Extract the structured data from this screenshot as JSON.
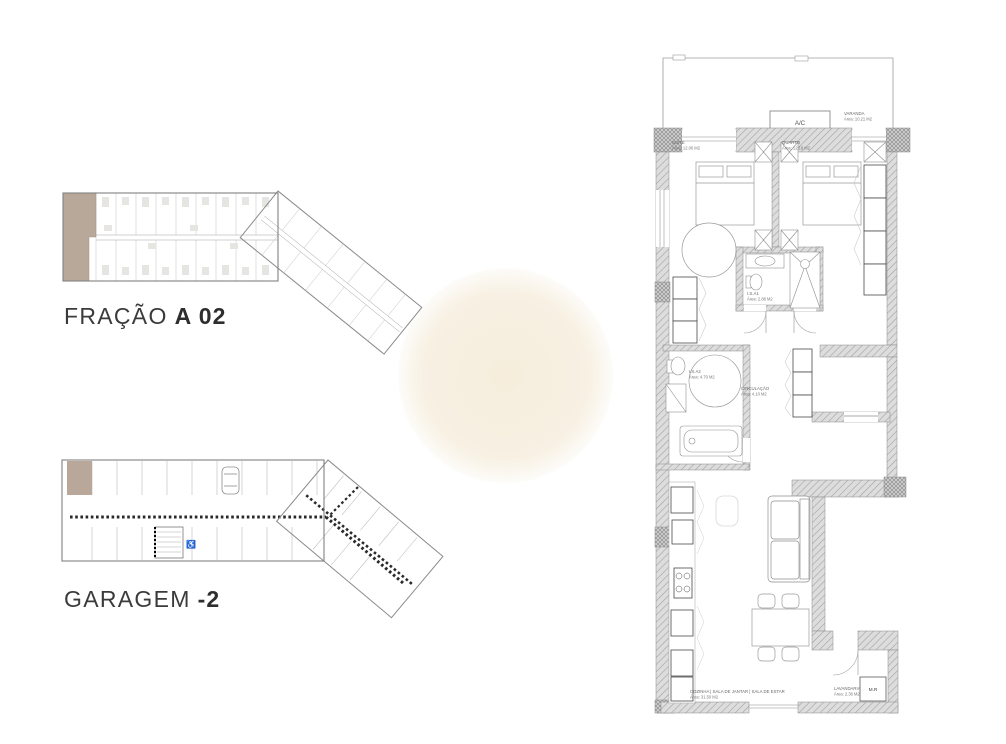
{
  "titles": {
    "fracao": {
      "regular": "FRAÇÃO",
      "bold": "A 02"
    },
    "garagem": {
      "regular": "GARAGEM",
      "bold": "-2"
    }
  },
  "apartment": {
    "ac_label": "A/C",
    "mr_label": "M.R",
    "rooms": {
      "varanda": {
        "name": "VARANDA",
        "area": "Área: 10.21 M2"
      },
      "suite": {
        "name": "SUÍTE",
        "area": "Área: 12.06 M2"
      },
      "quarto": {
        "name": "QUARTO",
        "area": "Área: 12.18 M2"
      },
      "is1": {
        "name": "I.S.A1",
        "area": "Área: 2.88 M2"
      },
      "is2": {
        "name": "I.S.A2",
        "area": "Área: 4.70 M2"
      },
      "circulacao": {
        "name": "CIRCULAÇÃO",
        "area": "Área: 4.10 M2"
      },
      "living": {
        "name": "COZINHA | SALA DE JANTAR | SALA DE ESTAR",
        "area": "Área: 31.50 M2"
      },
      "lavandaria": {
        "name": "LAVANDARIA",
        "area": "Área: 2.36 M2"
      }
    }
  },
  "colors": {
    "highlight": "#b3a191",
    "wall_fill": "#dcdcdc",
    "outline": "#8a8a8a",
    "title_text": "#3b3b3b",
    "watermark": "#f5ecda"
  }
}
